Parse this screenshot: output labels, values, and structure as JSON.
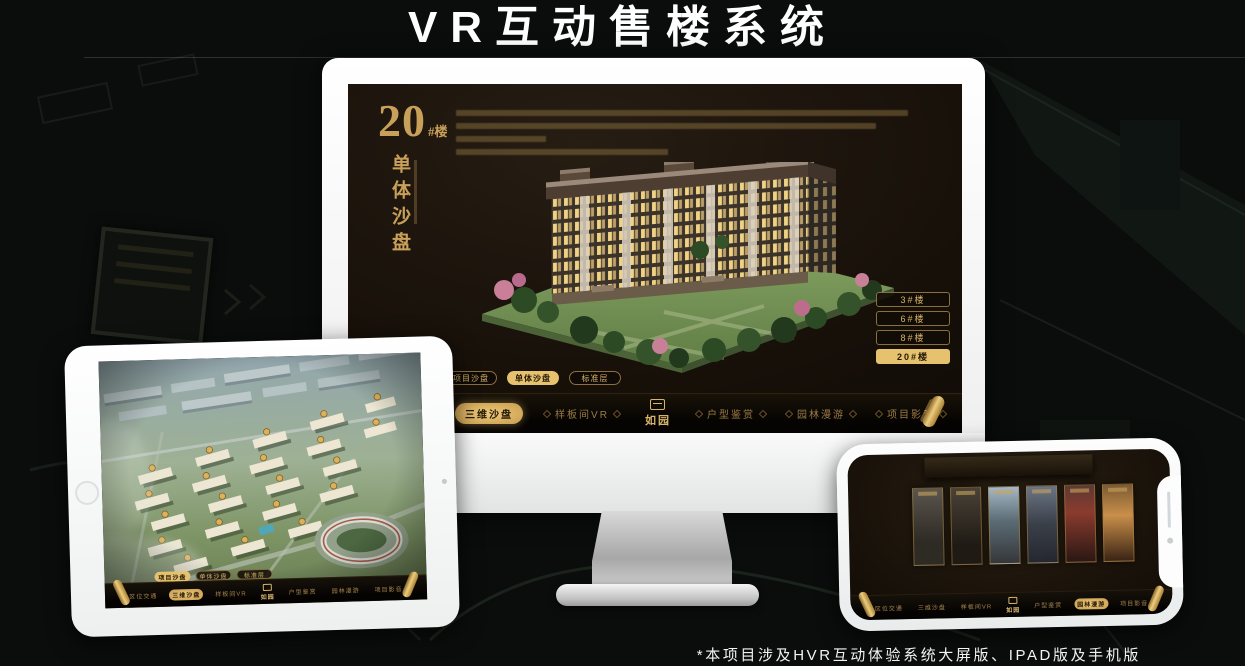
{
  "page": {
    "title": "VR互动售楼系统",
    "footnote": "*本项目涉及HVR互动体验系统大屏版、IPAD版及手机版"
  },
  "colors": {
    "accent_gold": "#d2a75f",
    "active_gold_bg": "#e6c26f",
    "screen_bg": "#171009",
    "menu_bar_bg": "#0a0806",
    "device_white": "#f7f8f8"
  },
  "monitor": {
    "header": {
      "building_number": "20",
      "building_suffix": "#楼",
      "subtitle": "单体沙盘"
    },
    "floor_buttons": [
      {
        "label": "3#楼",
        "active": false
      },
      {
        "label": "6#楼",
        "active": false
      },
      {
        "label": "8#楼",
        "active": false
      },
      {
        "label": "20#楼",
        "active": true
      }
    ],
    "mode_buttons": [
      {
        "label": "项目沙盘",
        "active": false
      },
      {
        "label": "单体沙盘",
        "active": true
      },
      {
        "label": "标准层",
        "active": false
      }
    ],
    "menu_left": [
      {
        "label": "区位交通",
        "active": false
      },
      {
        "label": "三维沙盘",
        "active": true
      },
      {
        "label": "样板间VR",
        "active": false
      }
    ],
    "logo": "如园",
    "menu_right": [
      {
        "label": "户型鉴赏",
        "active": false
      },
      {
        "label": "园林漫游",
        "active": false
      },
      {
        "label": "项目影音",
        "active": false
      }
    ]
  },
  "tablet": {
    "mode_buttons": [
      {
        "label": "项目沙盘",
        "active": true
      },
      {
        "label": "单体沙盘",
        "active": false
      },
      {
        "label": "标准层",
        "active": false
      }
    ],
    "menu_left": [
      {
        "label": "区位交通",
        "active": false
      },
      {
        "label": "三维沙盘",
        "active": true
      },
      {
        "label": "样板间VR",
        "active": false
      }
    ],
    "logo": "如园",
    "menu_right": [
      {
        "label": "户型鉴赏",
        "active": false
      },
      {
        "label": "园林漫游",
        "active": false
      },
      {
        "label": "项目影音",
        "active": false
      }
    ]
  },
  "phone": {
    "menu_left": [
      {
        "label": "区位交通",
        "active": false
      },
      {
        "label": "三维沙盘",
        "active": false
      },
      {
        "label": "样板间VR",
        "active": false
      }
    ],
    "logo": "如园",
    "menu_right": [
      {
        "label": "户型鉴赏",
        "active": false
      },
      {
        "label": "园林漫游",
        "active": true
      },
      {
        "label": "项目影音",
        "active": false
      }
    ]
  }
}
